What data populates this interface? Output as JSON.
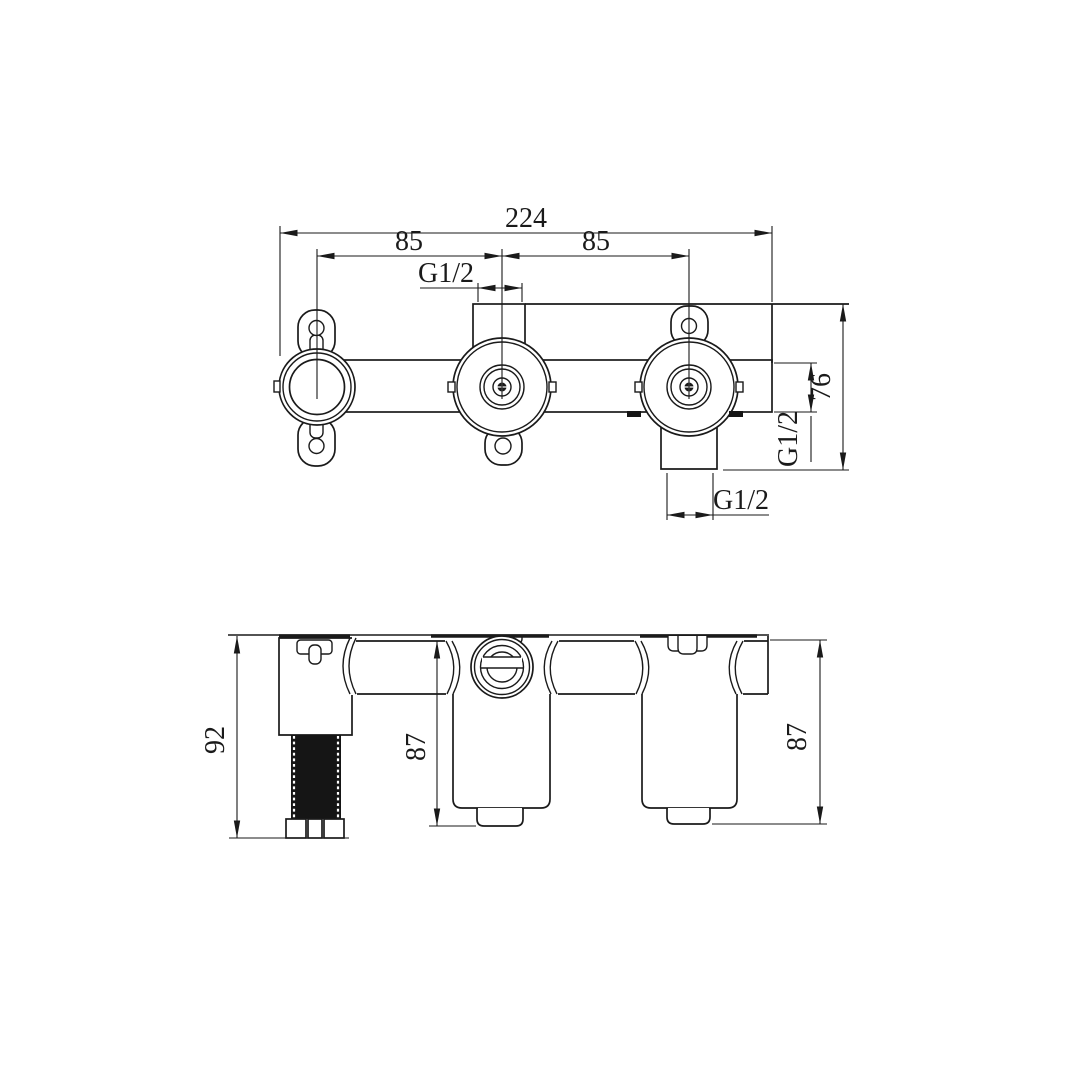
{
  "drawing": {
    "background": "#ffffff",
    "line_color": "#1a1a1a",
    "views": {
      "front_view": {
        "dims": {
          "overall_width": "224",
          "pitch_left": "85",
          "pitch_right": "85",
          "top_port_thread": "G1/2",
          "side_port_thread": "G1/2",
          "body_height": "76",
          "bottom_port_thread": "G1/2"
        }
      },
      "bottom_view": {
        "dims": {
          "left_valve_depth": "92",
          "center_valve_depth": "87",
          "right_valve_depth": "87"
        }
      }
    }
  }
}
